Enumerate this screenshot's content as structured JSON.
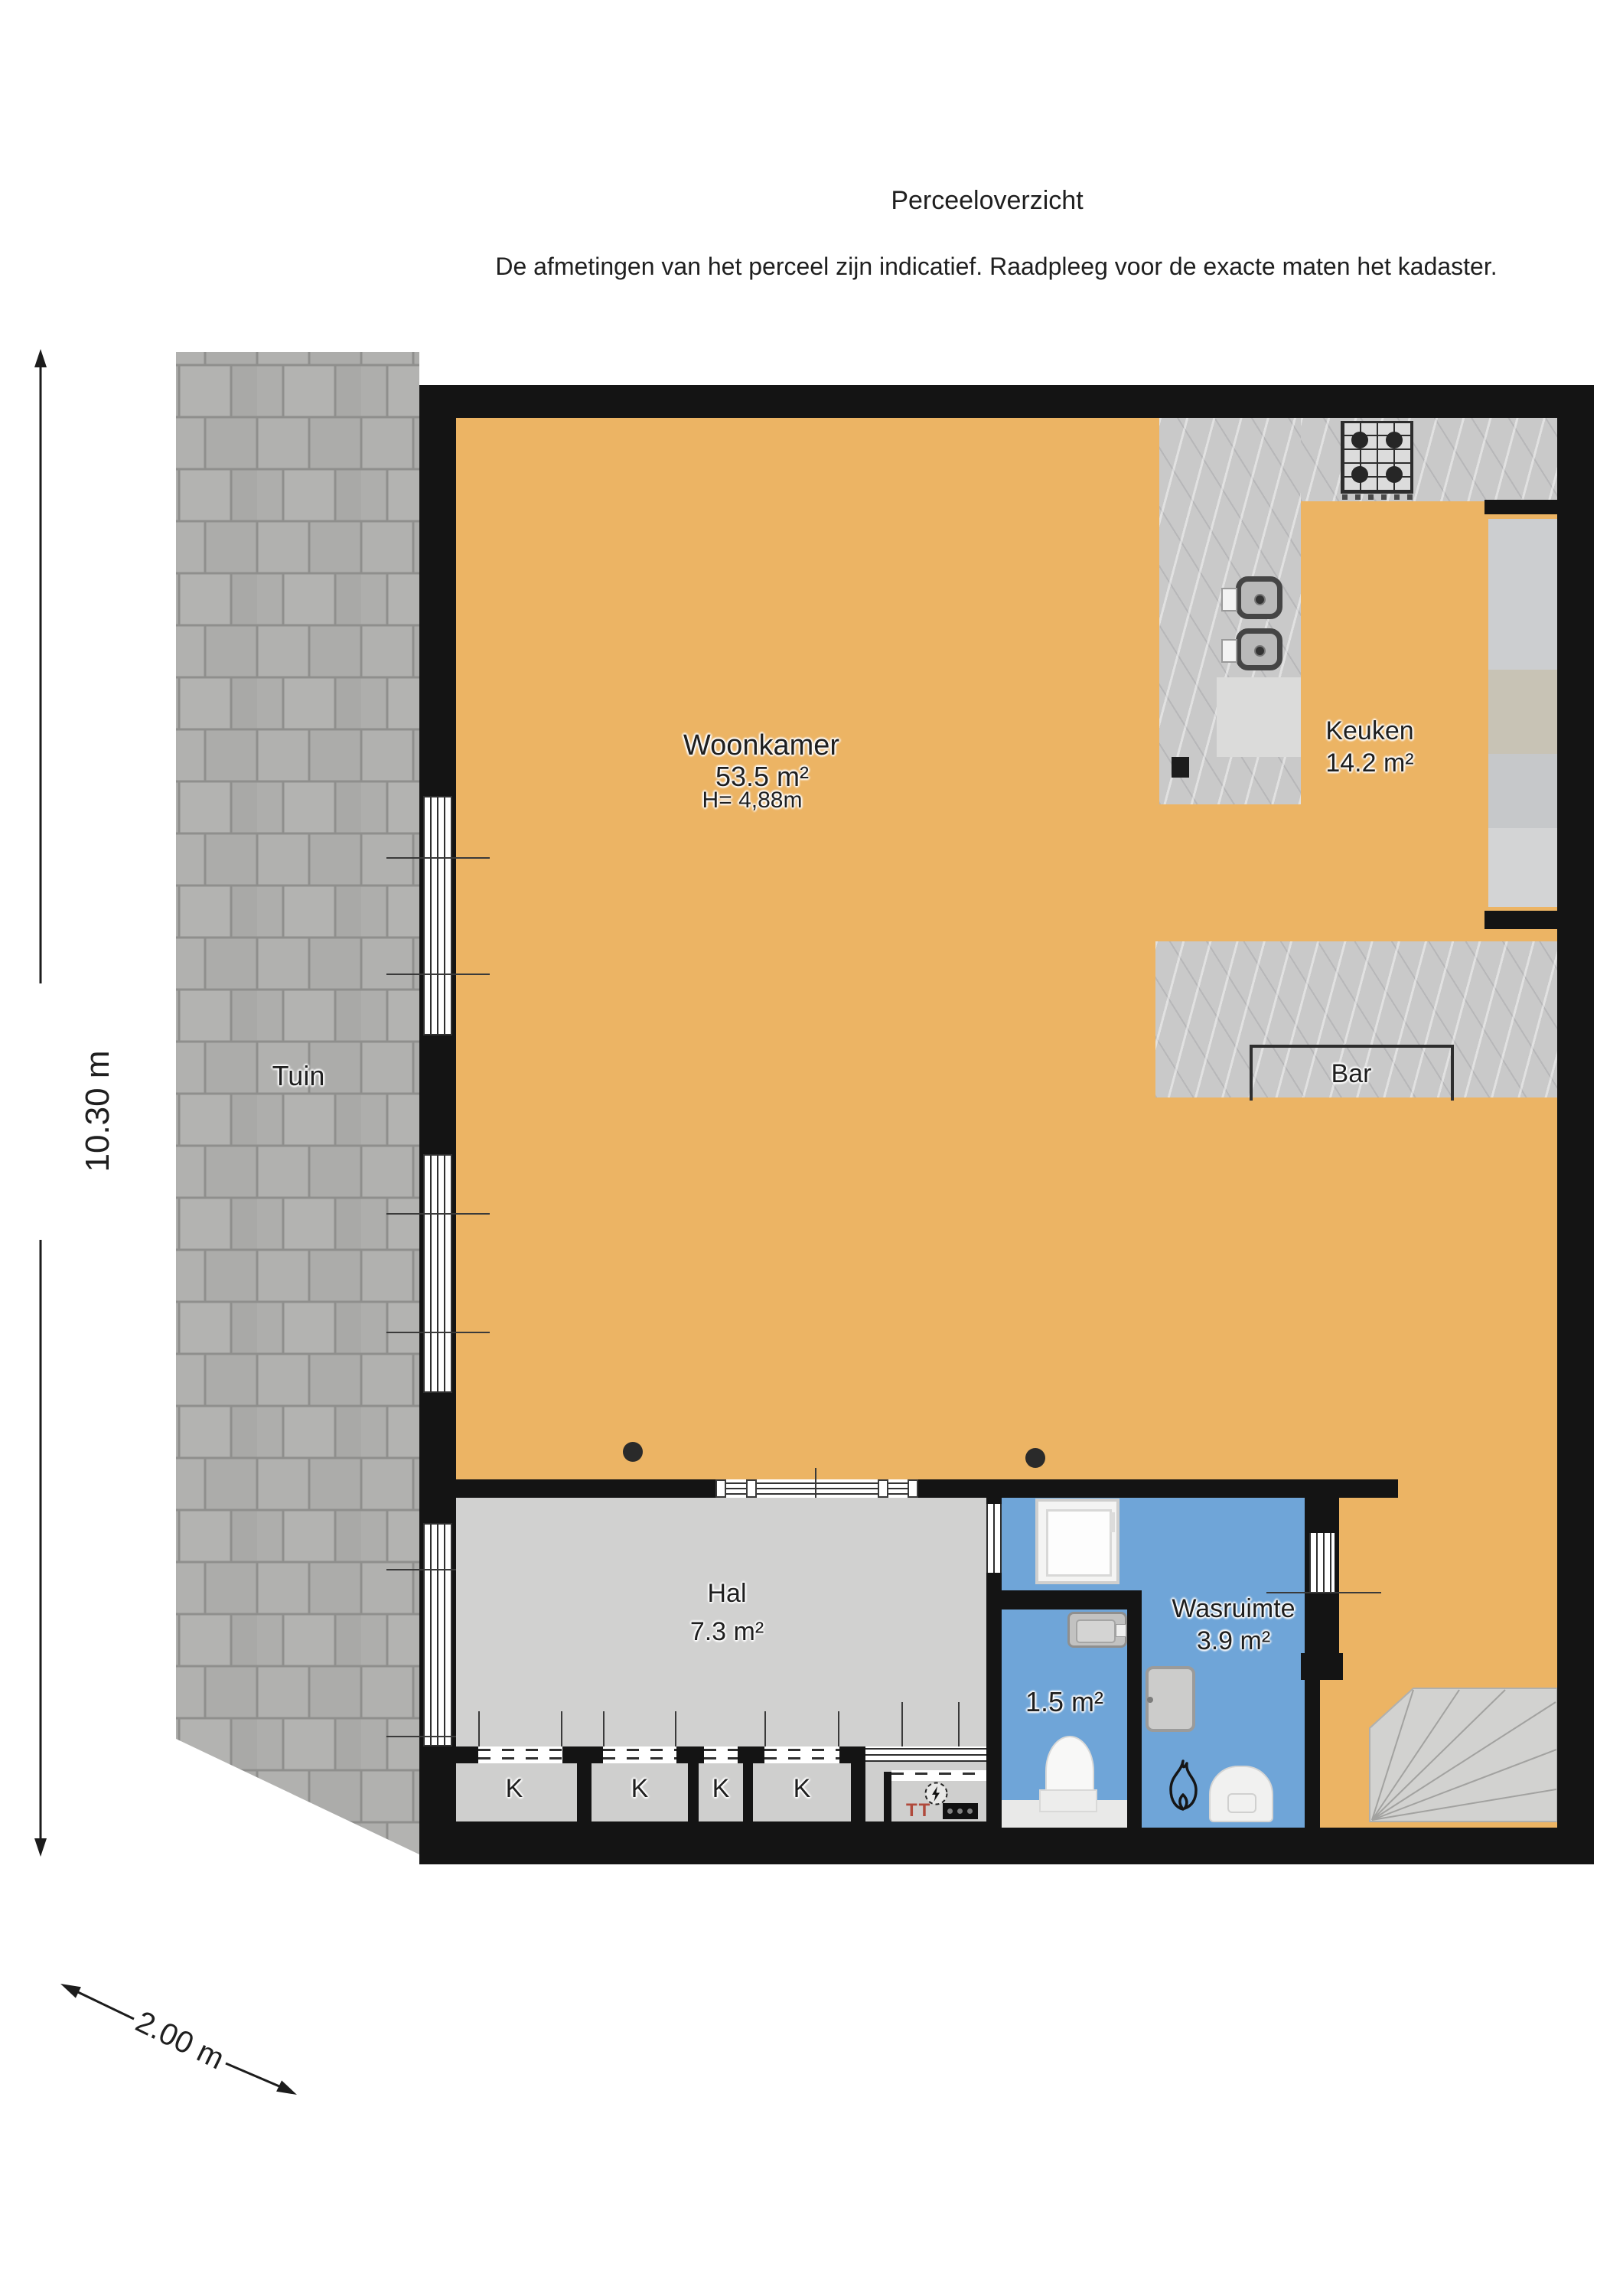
{
  "title": "Perceeloverzicht",
  "disclaimer": "De afmetingen van het perceel zijn indicatief. Raadpleeg voor de exacte maten het kadaster.",
  "dimensions": {
    "vertical": "10.30 m",
    "diagonal": "2.00 m"
  },
  "rooms": {
    "tuin": {
      "name": "Tuin"
    },
    "woonkamer": {
      "name": "Woonkamer",
      "area": "53.5 m²",
      "ceiling_height": "H= 4,88m"
    },
    "keuken": {
      "name": "Keuken",
      "area": "14.2 m²"
    },
    "bar": {
      "name": "Bar"
    },
    "hal": {
      "name": "Hal",
      "area": "7.3 m²"
    },
    "toilet": {
      "area": "1.5 m²"
    },
    "wasruimte": {
      "name": "Wasruimte",
      "area": "3.9 m²"
    }
  },
  "closets": [
    "K",
    "K",
    "K",
    "K"
  ],
  "icons": {
    "meter_label": "TT"
  },
  "colors": {
    "floor": "#ecb464",
    "wet": "#6fa5d8",
    "hall": "#d1d1d0",
    "wall": "#141414",
    "tile": "#aeaeac",
    "marble": "#c9c9c9",
    "closet": "#cfcfce"
  }
}
